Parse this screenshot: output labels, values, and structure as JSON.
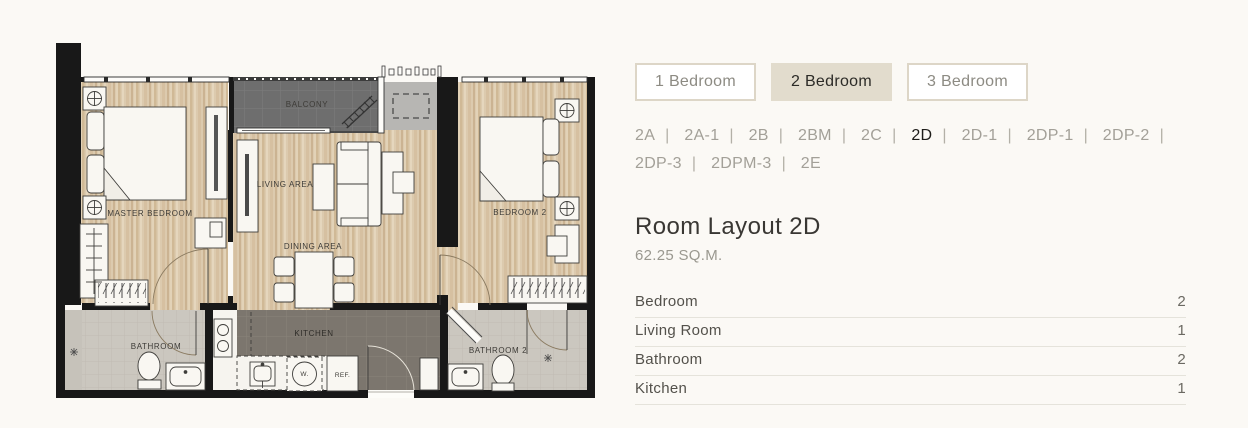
{
  "tabs": {
    "items": [
      {
        "label": "1 Bedroom",
        "active": false
      },
      {
        "label": "2 Bedroom",
        "active": true
      },
      {
        "label": "3 Bedroom",
        "active": false
      }
    ]
  },
  "unit_nav": {
    "separator": "|",
    "items": [
      {
        "label": "2A",
        "active": false
      },
      {
        "label": "2A-1",
        "active": false
      },
      {
        "label": "2B",
        "active": false
      },
      {
        "label": "2BM",
        "active": false
      },
      {
        "label": "2C",
        "active": false
      },
      {
        "label": "2D",
        "active": true
      },
      {
        "label": "2D-1",
        "active": false
      },
      {
        "label": "2DP-1",
        "active": false
      },
      {
        "label": "2DP-2",
        "active": false
      },
      {
        "label": "2DP-3",
        "active": false
      },
      {
        "label": "2DPM-3",
        "active": false
      },
      {
        "label": "2E",
        "active": false
      }
    ]
  },
  "layout_info": {
    "title": "Room Layout 2D",
    "area": "62.25 SQ.M."
  },
  "room_table": {
    "rows": [
      {
        "name": "Bedroom",
        "count": "2"
      },
      {
        "name": "Living Room",
        "count": "1"
      },
      {
        "name": "Bathroom",
        "count": "2"
      },
      {
        "name": "Kitchen",
        "count": "1"
      }
    ]
  },
  "floorplan": {
    "labels": {
      "balcony": "BALCONY",
      "living_area": "LIVING AREA",
      "dining_area": "DINING AREA",
      "master_bedroom": "MASTER BEDROOM",
      "bedroom2": "BEDROOM 2",
      "kitchen": "KITCHEN",
      "bathroom": "BATHROOM",
      "bathroom2": "BATHROOM 2",
      "fridge": "REF.",
      "washer": "W."
    }
  },
  "colors": {
    "page_bg": "#fbf9f5",
    "tab_active_bg": "#e2dccd",
    "wood_floor": "#dccaae",
    "balcony_floor": "#6e6e6e",
    "kitchen_floor": "#7c766e",
    "bathroom_floor": "#cbc7bf",
    "wall": "#181818"
  }
}
